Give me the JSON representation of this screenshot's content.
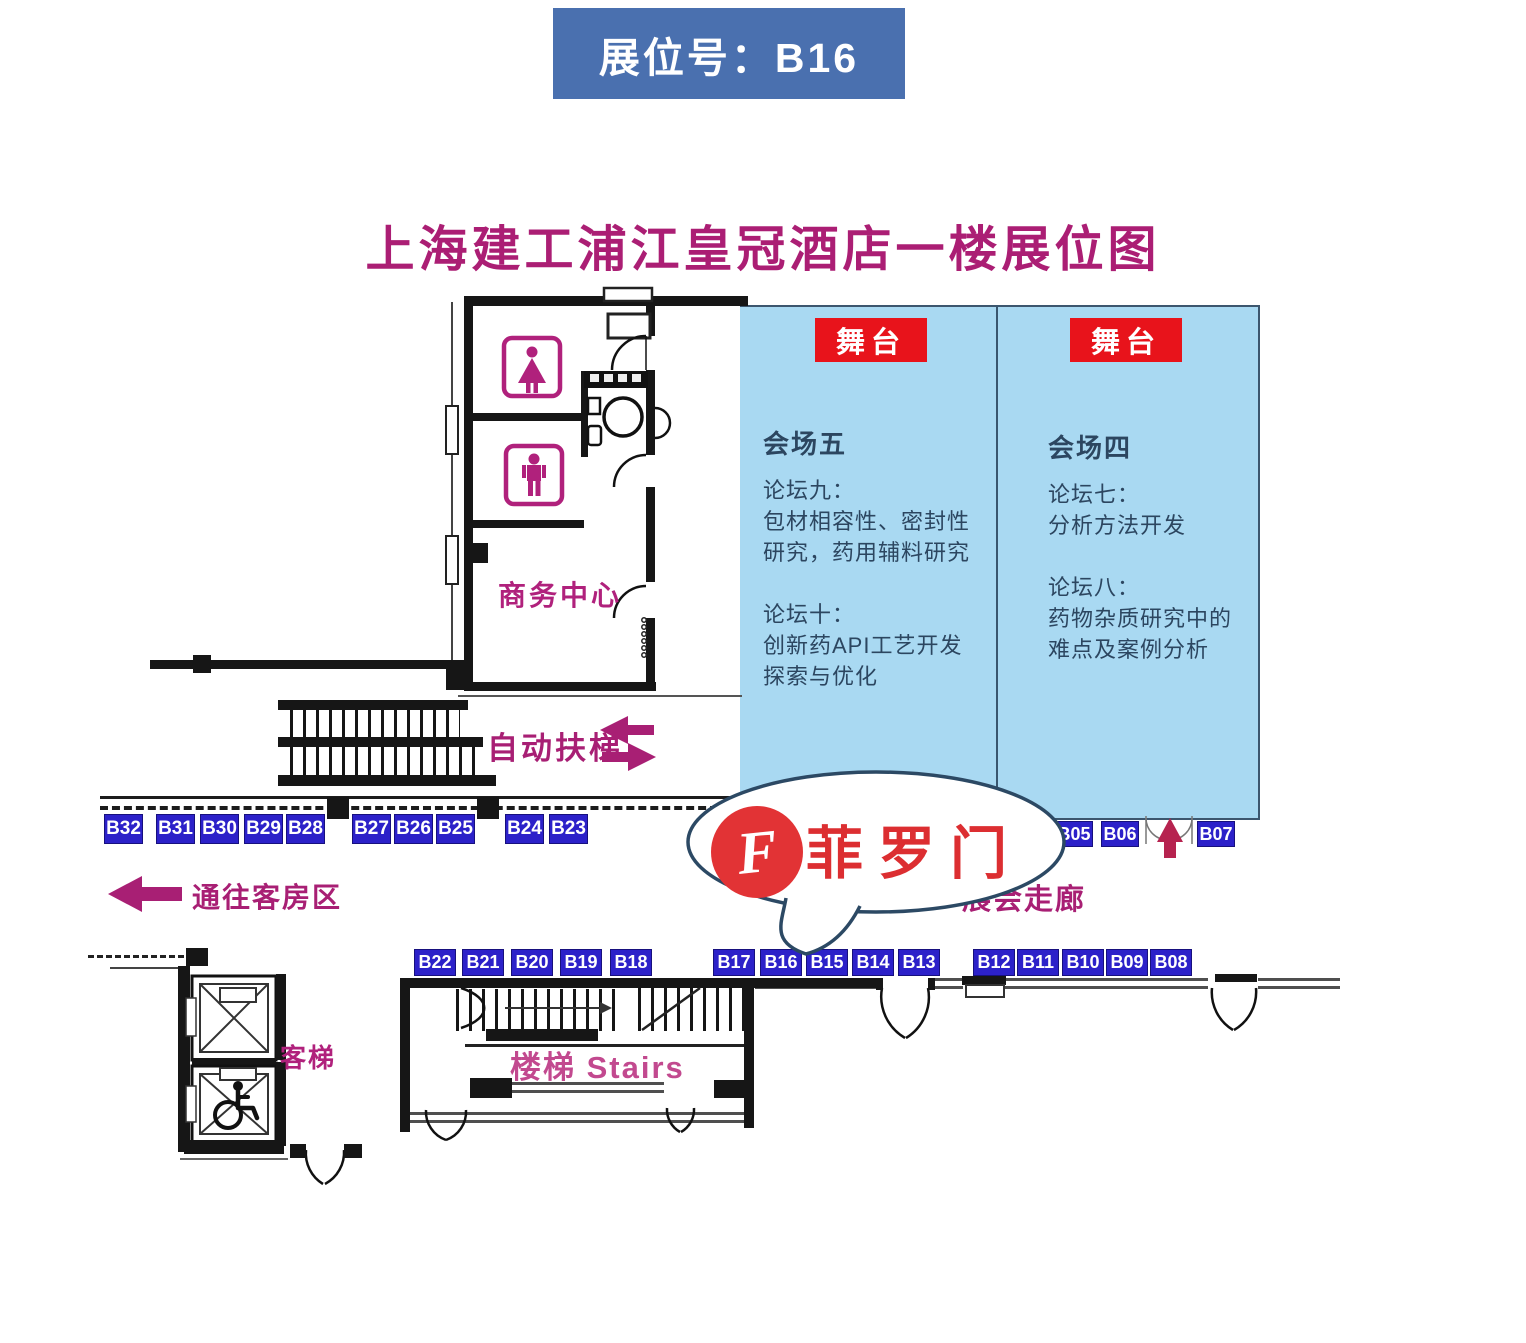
{
  "banner": {
    "label": "展位号：B16"
  },
  "title": "上海建工浦江皇冠酒店一楼展位图",
  "halls": {
    "left": {
      "stage": "舞台",
      "name": "会场五",
      "body": "论坛九：\n包材相容性、密封性\n研究，药用辅料研究\n\n论坛十：\n创新药API工艺开发\n探索与优化"
    },
    "right": {
      "stage": "舞台",
      "name": "会场四",
      "body": "论坛七：\n分析方法开发\n\n论坛八：\n药物杂质研究中的\n难点及案例分析"
    }
  },
  "labels": {
    "business_center": "商务中心",
    "escalator": "自动扶梯",
    "to_guest_rooms": "通往客房区",
    "corridor": "展会走廊",
    "elevator": "客梯",
    "stairs": "楼梯  Stairs"
  },
  "bubble": {
    "brand": "菲罗门",
    "logo_letter": "F"
  },
  "booths": {
    "row_top": [
      "B32",
      "B31",
      "B30",
      "B29",
      "B28",
      "B27",
      "B26",
      "B25",
      "B24",
      "B23"
    ],
    "row_right": [
      "B05",
      "B06",
      "B07"
    ],
    "row_bottom": [
      "B22",
      "B21",
      "B20",
      "B19",
      "B18",
      "B17",
      "B16",
      "B15",
      "B14",
      "B13",
      "B12",
      "B11",
      "B10",
      "B09",
      "B08"
    ]
  },
  "colors": {
    "banner_bg": "#4a70af",
    "title": "#ab1e74",
    "hall_bg": "#a9d9f2",
    "stage_red": "#e8131b",
    "booth_blue": "#2c21c9",
    "magenta": "#a81f74",
    "brand_red": "#dc2e31",
    "hall_text": "#2c4660"
  }
}
